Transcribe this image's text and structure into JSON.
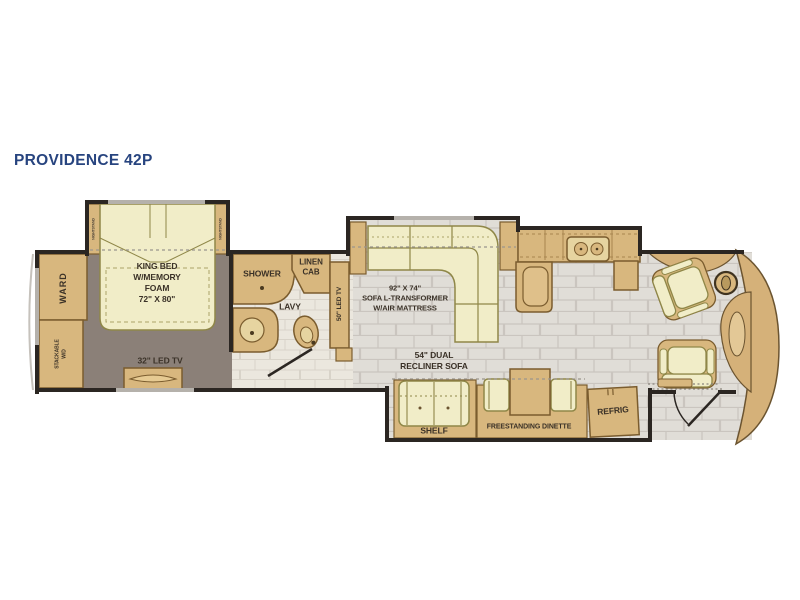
{
  "title": "PROVIDENCE 42P",
  "colors": {
    "title_blue": "#27447f",
    "wall_dark": "#2b2622",
    "wood_tan": "#d8b77e",
    "wood_border": "#7a5c2e",
    "soft_yellow": "#f1edc8",
    "soft_border": "#8f8748",
    "floor_living": "#e0ddd7",
    "floor_bath": "#ebe7de",
    "floor_bedroom": "#8b8078",
    "window_gray": "#b5b1ab",
    "label_text": "#3a3127"
  },
  "labels": {
    "ward": "WARD",
    "stackable_wd": "STACKABLE\nW/D",
    "nightstand_left": "NIGHTSTAND",
    "nightstand_right": "NIGHTSTAND",
    "king_bed": "KING BED\nW/MEMORY\nFOAM\n72\" X 80\"",
    "tv_32": "32\" LED TV",
    "shower": "SHOWER",
    "linen_cab": "LINEN\nCAB",
    "lavy": "LAVY",
    "tv_50": "50\" LED TV",
    "sofa": "92\" X 74\"\nSOFA L-TRANSFORMER\nW/AIR MATTRESS",
    "recliner_sofa": "54\" DUAL\nRECLINER SOFA",
    "shelf": "SHELF",
    "dinette": "FREESTANDING DINETTE",
    "refrig": "REFRIG"
  }
}
